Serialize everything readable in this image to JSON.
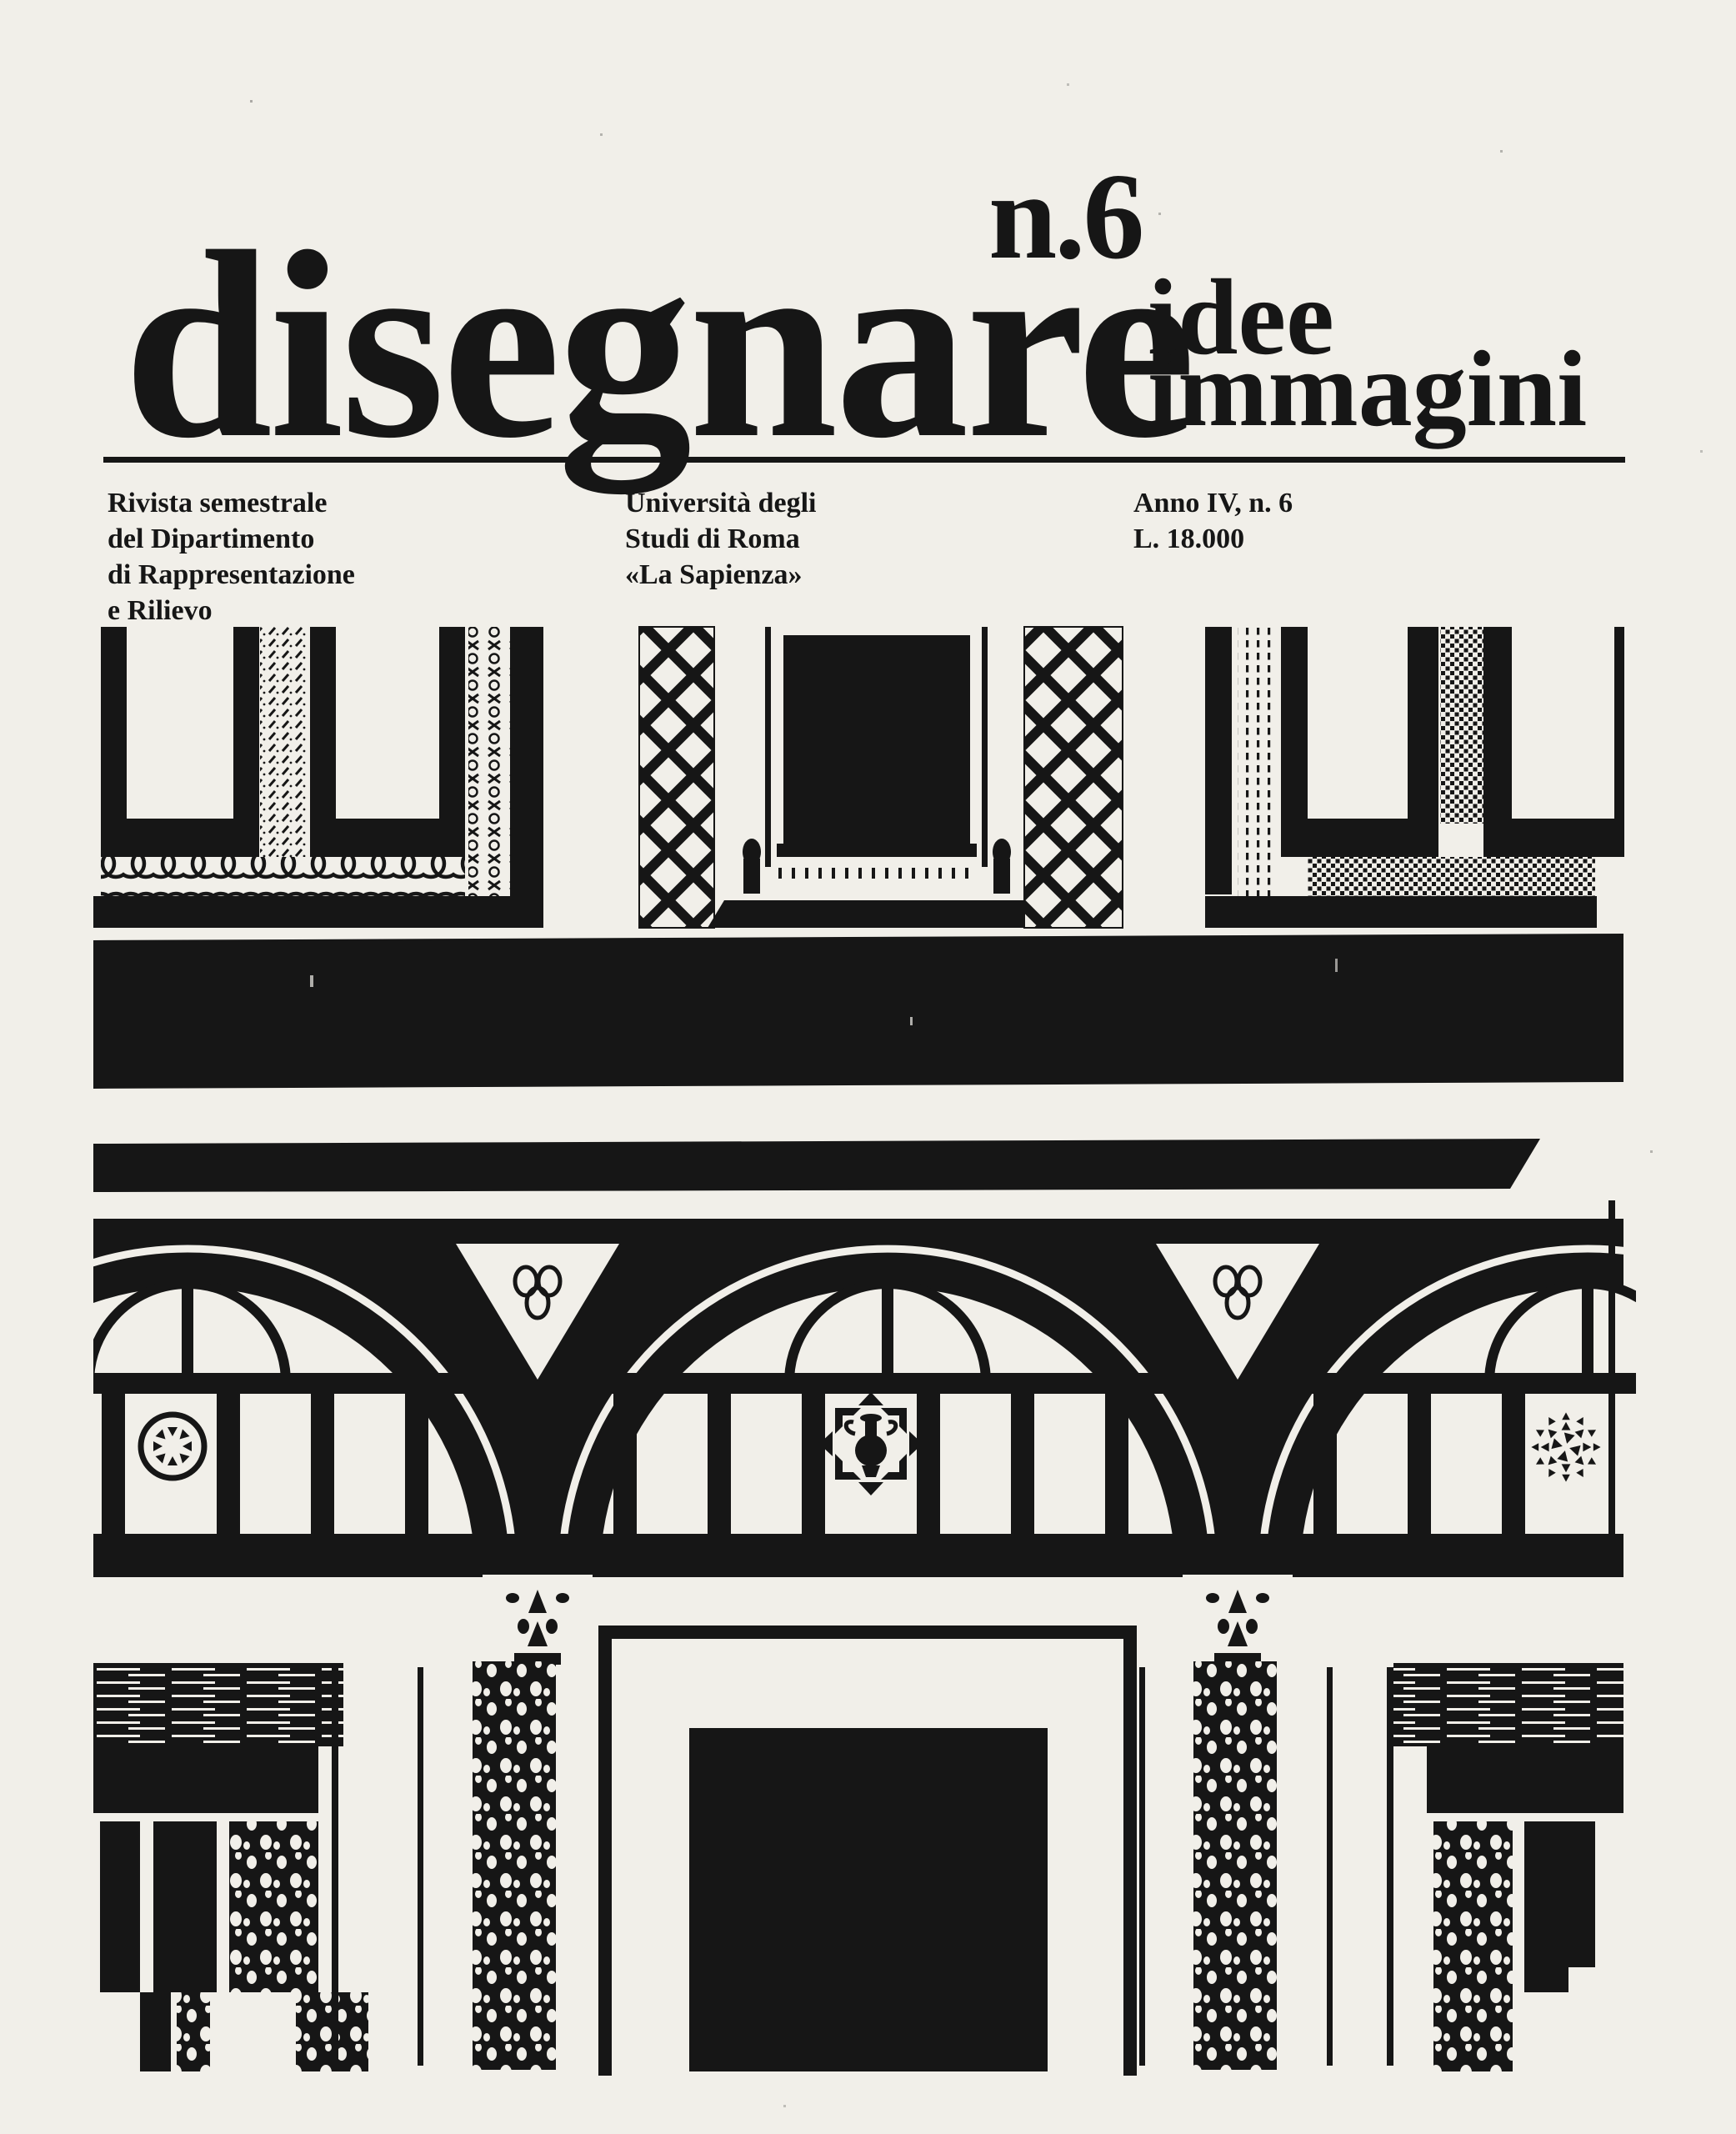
{
  "masthead": {
    "issue": "n.6",
    "title": "disegnare",
    "subtitle_line1": "idee",
    "subtitle_line2": "immagini"
  },
  "publication": {
    "about": [
      "Rivista semestrale",
      "del Dipartimento",
      "di Rappresentazione",
      "e Rilievo"
    ],
    "university": [
      "Università degli",
      "Studi di Roma",
      "«La Sapienza»"
    ],
    "issue_info": [
      "Anno IV, n. 6",
      "L. 18.000"
    ]
  },
  "cover_photo": {
    "alt": "High-contrast black and white photograph of a Renaissance palazzo courtyard facade: sgraffito-framed upper windows, a heavy dark frieze, round-arched bays with trefoil spandrel ornaments, rosette and vase medallions, mullioned windows, Corinthian capitals on columns and dark portals below"
  },
  "colors": {
    "paper": "#f1efe9",
    "ink": "#161616"
  }
}
